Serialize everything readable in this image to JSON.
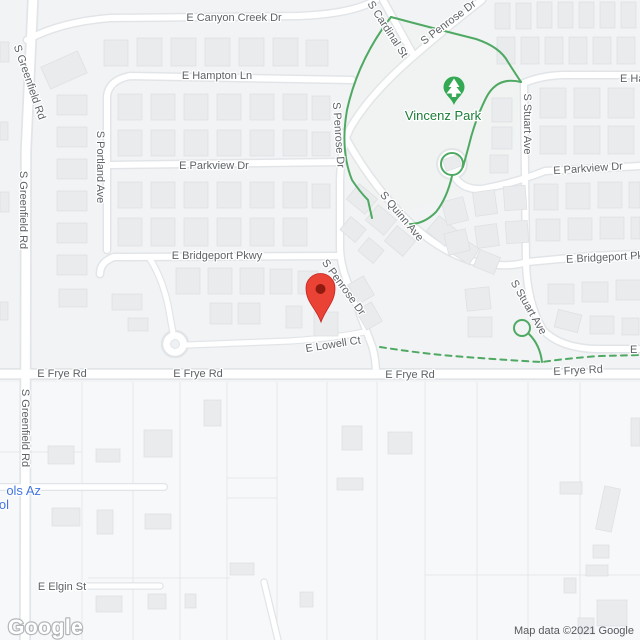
{
  "watermark": {
    "logo": "Google",
    "attribution": "Map data ©2021 Google"
  },
  "park": {
    "name": "Vincenz Park"
  },
  "streets": {
    "canyon_creek": "E Canyon Creek Dr",
    "greenfield": "S Greenfield Rd",
    "hampton": "E Hampton Ln",
    "portland": "S Portland Ave",
    "cardinal": "S Cardinal St",
    "penrose": "S Penrose Dr",
    "quinn": "S Quinn Ave",
    "stuart": "S Stuart Ave",
    "parkview": "E Parkview Dr",
    "bridgeport": "E Bridgeport Pkwy",
    "lowell": "E Lowell Ct",
    "frye": "E Frye Rd",
    "elgin": "E Elgin St"
  },
  "partial_labels": {
    "school_line1": "ols Az",
    "school_line2": "ol",
    "east_edge": "E"
  },
  "colors": {
    "pin_red": "#ea4335",
    "pin_dot": "#8f1a10",
    "park_marker_green": "#34a853",
    "park_text_green": "#1a7d37",
    "path_green": "#4fa963",
    "school_blue": "#4374e0"
  }
}
